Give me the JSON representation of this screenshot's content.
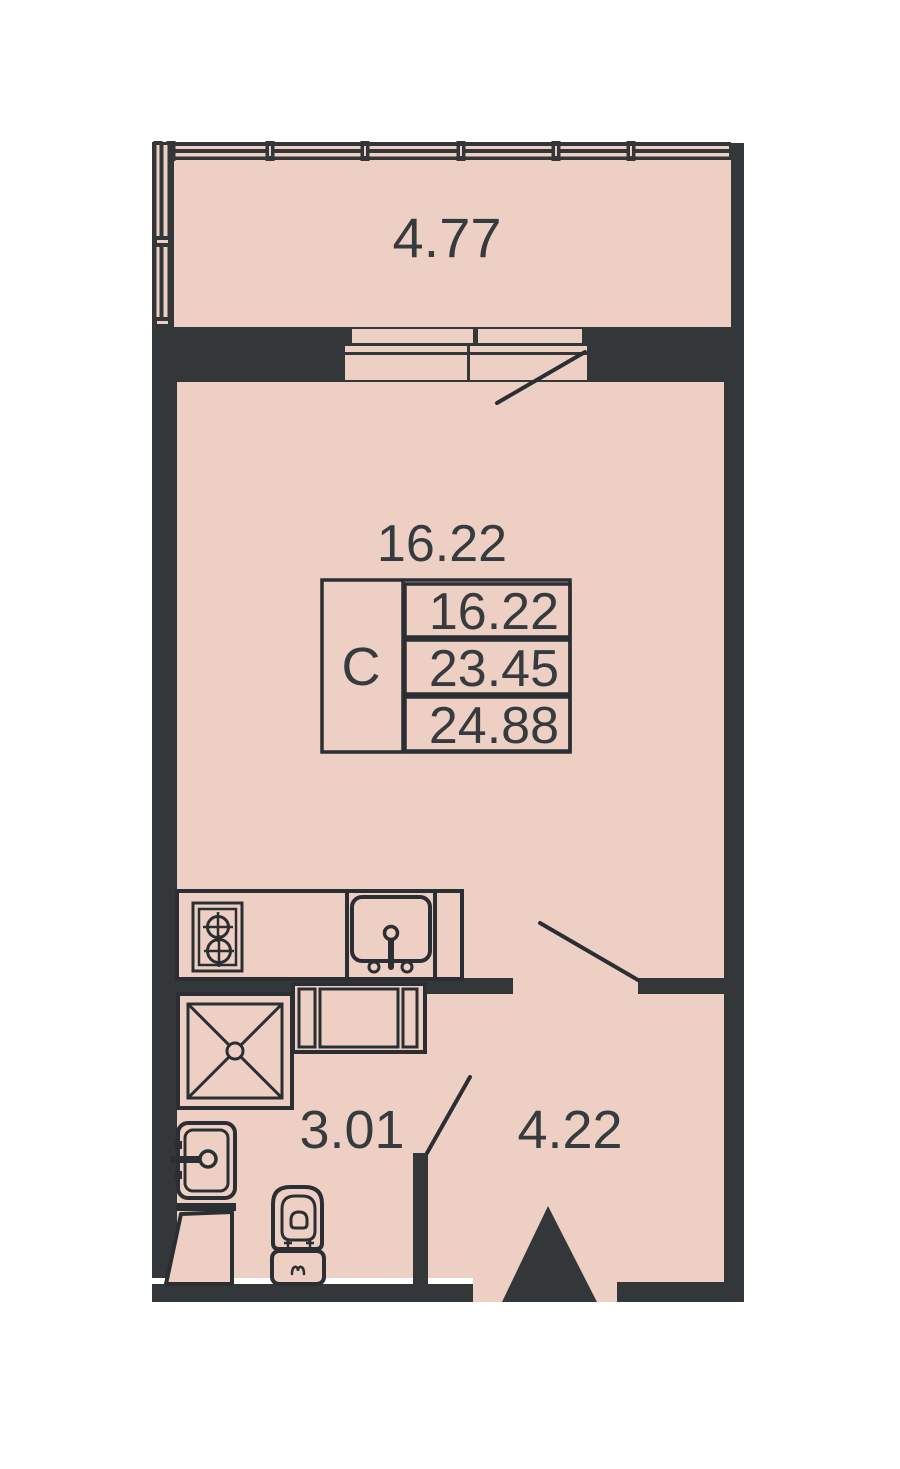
{
  "floorplan": {
    "labels": {
      "balcony_area": "4.77",
      "room_area": "16.22",
      "bathroom_area": "3.01",
      "hall_area": "4.22"
    },
    "info_box": {
      "type": "С",
      "rows": [
        "16.22",
        "23.45",
        "24.88"
      ]
    }
  },
  "colors": {
    "floor": "#edd0c3",
    "wall": "#33373a",
    "line": "#2b2f33",
    "text": "#363b3f",
    "bg": "#ffffff"
  }
}
